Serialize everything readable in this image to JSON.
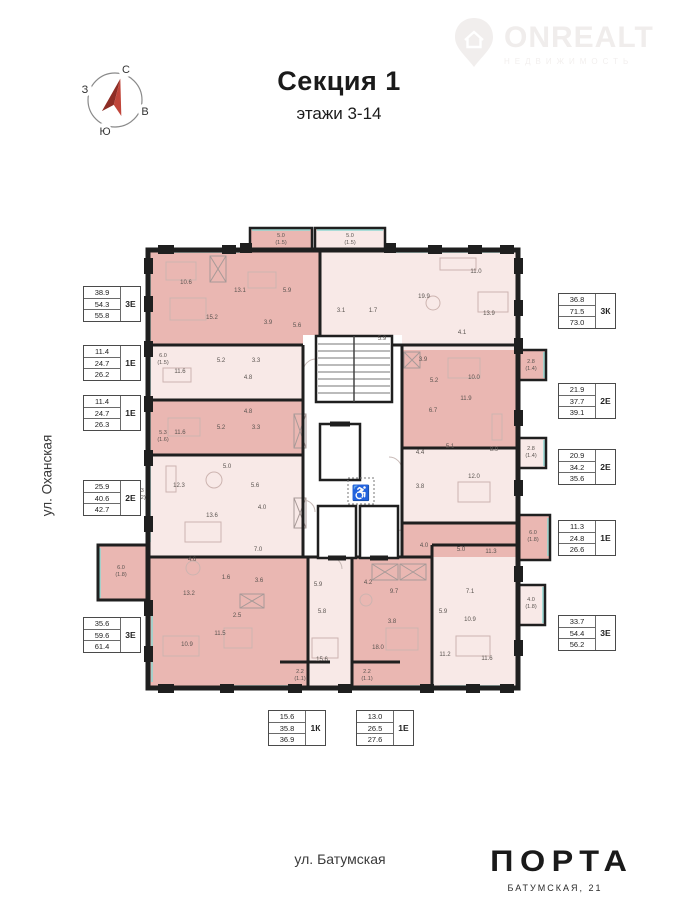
{
  "header": {
    "title": "Секция 1",
    "subtitle": "этажи 3-14"
  },
  "watermark": {
    "name": "ONREALT",
    "tagline": "НЕДВИЖИМОСТЬ"
  },
  "compass": {
    "n": "С",
    "e": "В",
    "s": "Ю",
    "w": "З"
  },
  "streets": {
    "left": "ул. Оханская",
    "bottom": "ул. Батумская"
  },
  "brand": {
    "logo": "ПОРТА",
    "address": "БАТУМСКАЯ, 21"
  },
  "colors": {
    "apartment_dark": "#eab7b2",
    "apartment_light": "#f8e9e7",
    "wall": "#1f1f1f",
    "glazing": "#8fd8d2",
    "compass_arrow": "#b23b31"
  },
  "apartment_labels": {
    "left": [
      {
        "x": 83,
        "y": 286,
        "values": [
          "38.9",
          "54.3",
          "55.8"
        ],
        "type": "3Е"
      },
      {
        "x": 83,
        "y": 345,
        "values": [
          "11.4",
          "24.7",
          "26.2"
        ],
        "type": "1Е"
      },
      {
        "x": 83,
        "y": 395,
        "values": [
          "11.4",
          "24.7",
          "26.3"
        ],
        "type": "1Е"
      },
      {
        "x": 83,
        "y": 480,
        "values": [
          "25.9",
          "40.6",
          "42.7"
        ],
        "type": "2Е"
      },
      {
        "x": 83,
        "y": 617,
        "values": [
          "35.6",
          "59.6",
          "61.4"
        ],
        "type": "3Е"
      }
    ],
    "right": [
      {
        "x": 558,
        "y": 293,
        "values": [
          "36.8",
          "71.5",
          "73.0"
        ],
        "type": "3К"
      },
      {
        "x": 558,
        "y": 383,
        "values": [
          "21.9",
          "37.7",
          "39.1"
        ],
        "type": "2Е"
      },
      {
        "x": 558,
        "y": 449,
        "values": [
          "20.9",
          "34.2",
          "35.6"
        ],
        "type": "2Е"
      },
      {
        "x": 558,
        "y": 520,
        "values": [
          "11.3",
          "24.8",
          "26.6"
        ],
        "type": "1Е"
      },
      {
        "x": 558,
        "y": 615,
        "values": [
          "33.7",
          "54.4",
          "56.2"
        ],
        "type": "3Е"
      }
    ],
    "bottom": [
      {
        "x": 268,
        "y": 710,
        "values": [
          "15.6",
          "35.8",
          "36.9"
        ],
        "type": "1К"
      },
      {
        "x": 356,
        "y": 710,
        "values": [
          "13.0",
          "26.5",
          "27.6"
        ],
        "type": "1Е"
      }
    ]
  },
  "balcony_labels": [
    {
      "x": 281,
      "y": 240,
      "value": "5.0",
      "sub": "(1.5)"
    },
    {
      "x": 350,
      "y": 240,
      "value": "5.0",
      "sub": "(1.5)"
    },
    {
      "x": 163,
      "y": 360,
      "value": "6.0",
      "sub": "(1.5)"
    },
    {
      "x": 163,
      "y": 437,
      "value": "5.3",
      "sub": "(1.6)"
    },
    {
      "x": 140,
      "y": 495,
      "value": "7.3",
      "sub": "(2.2)"
    },
    {
      "x": 121,
      "y": 572,
      "value": "6.0",
      "sub": "(1.8)"
    },
    {
      "x": 531,
      "y": 366,
      "value": "2.8",
      "sub": "(1.4)"
    },
    {
      "x": 531,
      "y": 453,
      "value": "2.8",
      "sub": "(1.4)"
    },
    {
      "x": 533,
      "y": 537,
      "value": "6.0",
      "sub": "(1.8)"
    },
    {
      "x": 531,
      "y": 604,
      "value": "4.0",
      "sub": "(1.8)"
    },
    {
      "x": 300,
      "y": 676,
      "value": "2.2",
      "sub": "(1.1)"
    },
    {
      "x": 367,
      "y": 676,
      "value": "2.2",
      "sub": "(1.1)"
    }
  ],
  "room_labels": [
    {
      "x": 186,
      "y": 283,
      "text": "10.6"
    },
    {
      "x": 212,
      "y": 318,
      "text": "15.2"
    },
    {
      "x": 240,
      "y": 291,
      "text": "13.1"
    },
    {
      "x": 287,
      "y": 291,
      "text": "5.9"
    },
    {
      "x": 268,
      "y": 323,
      "text": "3.9"
    },
    {
      "x": 297,
      "y": 326,
      "text": "5.6"
    },
    {
      "x": 424,
      "y": 297,
      "text": "19.9"
    },
    {
      "x": 476,
      "y": 272,
      "text": "11.0"
    },
    {
      "x": 489,
      "y": 314,
      "text": "13.9"
    },
    {
      "x": 462,
      "y": 333,
      "text": "4.1"
    },
    {
      "x": 373,
      "y": 311,
      "text": "1.7"
    },
    {
      "x": 382,
      "y": 339,
      "text": "5.9"
    },
    {
      "x": 341,
      "y": 311,
      "text": "3.1"
    },
    {
      "x": 180,
      "y": 372,
      "text": "11.6"
    },
    {
      "x": 221,
      "y": 361,
      "text": "5.2"
    },
    {
      "x": 256,
      "y": 361,
      "text": "3.3"
    },
    {
      "x": 248,
      "y": 378,
      "text": "4.8"
    },
    {
      "x": 180,
      "y": 433,
      "text": "11.6"
    },
    {
      "x": 221,
      "y": 428,
      "text": "5.2"
    },
    {
      "x": 256,
      "y": 428,
      "text": "3.3"
    },
    {
      "x": 248,
      "y": 412,
      "text": "4.8"
    },
    {
      "x": 179,
      "y": 486,
      "text": "12.3"
    },
    {
      "x": 227,
      "y": 467,
      "text": "5.0"
    },
    {
      "x": 255,
      "y": 486,
      "text": "5.6"
    },
    {
      "x": 212,
      "y": 516,
      "text": "13.6"
    },
    {
      "x": 262,
      "y": 508,
      "text": "4.0"
    },
    {
      "x": 192,
      "y": 560,
      "text": "4.6"
    },
    {
      "x": 258,
      "y": 550,
      "text": "7.0"
    },
    {
      "x": 226,
      "y": 578,
      "text": "1.6"
    },
    {
      "x": 259,
      "y": 581,
      "text": "3.6"
    },
    {
      "x": 189,
      "y": 594,
      "text": "13.2"
    },
    {
      "x": 237,
      "y": 616,
      "text": "2.5"
    },
    {
      "x": 220,
      "y": 634,
      "text": "11.5"
    },
    {
      "x": 187,
      "y": 645,
      "text": "10.9"
    },
    {
      "x": 322,
      "y": 660,
      "text": "15.6"
    },
    {
      "x": 322,
      "y": 612,
      "text": "5.8"
    },
    {
      "x": 318,
      "y": 585,
      "text": "5.9"
    },
    {
      "x": 368,
      "y": 583,
      "text": "4.2"
    },
    {
      "x": 392,
      "y": 622,
      "text": "3.8"
    },
    {
      "x": 378,
      "y": 648,
      "text": "18.0"
    },
    {
      "x": 394,
      "y": 592,
      "text": "9.7"
    },
    {
      "x": 443,
      "y": 612,
      "text": "5.9"
    },
    {
      "x": 470,
      "y": 592,
      "text": "7.1"
    },
    {
      "x": 470,
      "y": 620,
      "text": "10.9"
    },
    {
      "x": 445,
      "y": 655,
      "text": "11.2"
    },
    {
      "x": 487,
      "y": 659,
      "text": "11.6"
    },
    {
      "x": 423,
      "y": 360,
      "text": "3.9"
    },
    {
      "x": 434,
      "y": 381,
      "text": "5.2"
    },
    {
      "x": 474,
      "y": 378,
      "text": "10.0"
    },
    {
      "x": 466,
      "y": 399,
      "text": "11.9"
    },
    {
      "x": 433,
      "y": 411,
      "text": "6.7"
    },
    {
      "x": 420,
      "y": 453,
      "text": "4.4"
    },
    {
      "x": 450,
      "y": 447,
      "text": "5.1"
    },
    {
      "x": 494,
      "y": 450,
      "text": "8.9"
    },
    {
      "x": 474,
      "y": 477,
      "text": "12.0"
    },
    {
      "x": 420,
      "y": 487,
      "text": "3.8"
    },
    {
      "x": 424,
      "y": 546,
      "text": "4.0"
    },
    {
      "x": 461,
      "y": 550,
      "text": "5.0"
    },
    {
      "x": 491,
      "y": 552,
      "text": "11.3"
    }
  ]
}
